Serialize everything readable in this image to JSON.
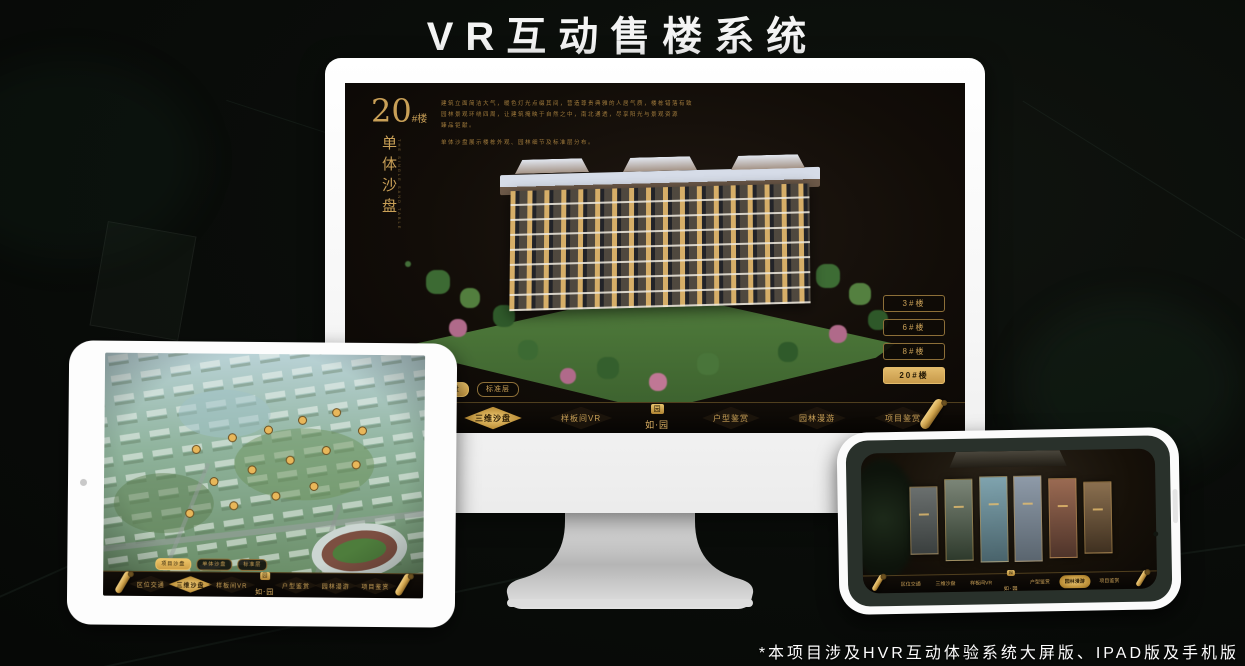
{
  "page": {
    "title": "VR互动售楼系统",
    "footnote": "*本项目涉及HVR互动体验系统大屏版、IPAD版及手机版"
  },
  "colors": {
    "accent_gold": "#c9a057",
    "accent_gold_bright": "#eec569",
    "screen_bg": "#120d08",
    "device_white": "#fdfdfd"
  },
  "brand": {
    "name": "如·园",
    "seal_char": "园"
  },
  "nav": {
    "items": [
      {
        "label": "区位交通"
      },
      {
        "label": "三维沙盘"
      },
      {
        "label": "样板间VR"
      },
      {
        "label": "户型鉴赏"
      },
      {
        "label": "园林漫游"
      },
      {
        "label": "项目鉴赏"
      }
    ]
  },
  "sub_tabs": {
    "items": [
      {
        "label": "项目沙盘"
      },
      {
        "label": "单体沙盘"
      },
      {
        "label": "标准层"
      }
    ]
  },
  "monitor": {
    "headline_number": "20",
    "headline_suffix": "#楼",
    "headline_vertical": "单体沙盘",
    "headline_caption": "THE SINGLE SAND TABLE",
    "desc": {
      "line1": "建筑立面简洁大气，暖色灯光点缀其间，营造尊贵典雅的人居气质，楼栋错落有致",
      "line2": "园林景观环绕四周，让建筑掩映于自然之中，南北通透，尽享阳光与景观资源",
      "line3": "臻品钜献。",
      "line4": "单体沙盘展示楼栋外观、园林细节及标准层分布。"
    },
    "floor_buttons": [
      {
        "label": "3#楼",
        "active": false
      },
      {
        "label": "6#楼",
        "active": false
      },
      {
        "label": "8#楼",
        "active": false
      },
      {
        "label": "20#楼",
        "active": true
      }
    ],
    "active_sub_tab": "单体沙盘",
    "active_nav_item": "三维沙盘"
  },
  "tablet": {
    "active_sub_tab": "项目沙盘",
    "active_nav_item": "三维沙盘"
  },
  "phone": {
    "active_nav_item": "园林漫游"
  }
}
